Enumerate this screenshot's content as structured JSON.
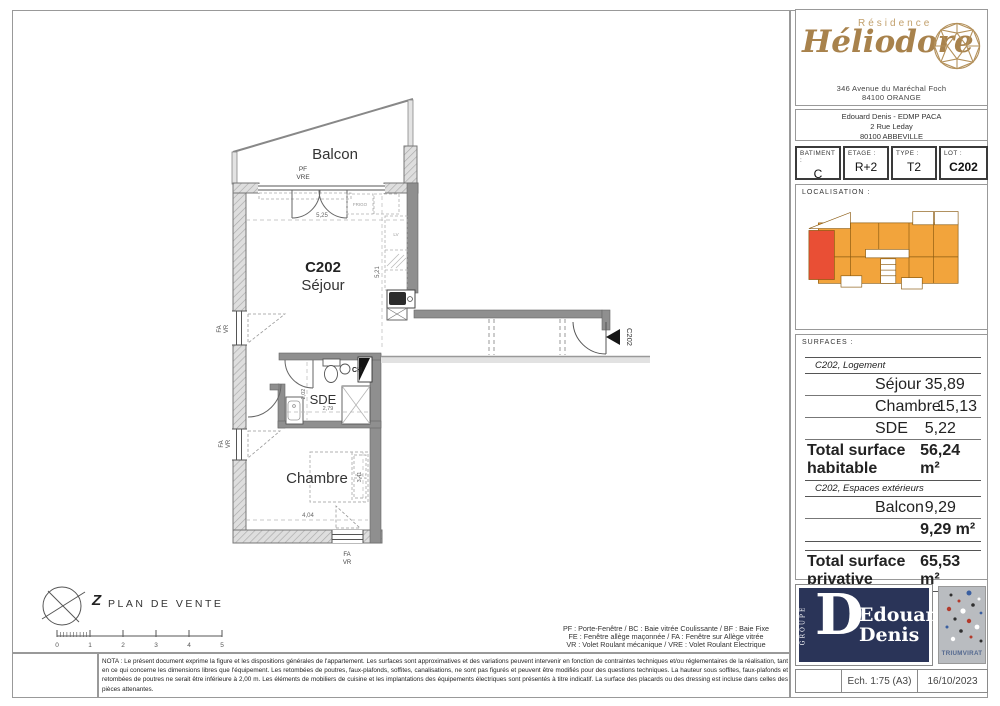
{
  "sheet": {
    "residence_label": "Résidence",
    "residence_name": "Héliodore",
    "residence_address1": "346 Avenue du Maréchal Foch",
    "residence_address2": "84100 ORANGE",
    "promoter_line1": "Edouard Denis - EDMP PACA",
    "promoter_line2": "2 Rue Leday",
    "promoter_line3": "80100 ABBEVILLE"
  },
  "lot": {
    "cells": [
      {
        "label": "BATIMENT :",
        "value": "C"
      },
      {
        "label": "ETAGE :",
        "value": "R+2"
      },
      {
        "label": "TYPE :",
        "value": "T2"
      },
      {
        "label": "LOT :",
        "value": "C202"
      }
    ]
  },
  "localisation": {
    "label": "LOCALISATION :"
  },
  "surfaces": {
    "label": "SURFACES :",
    "group1_title": "C202, Logement",
    "rows1": [
      {
        "name": "Séjour",
        "value": "35,89"
      },
      {
        "name": "Chambre",
        "value": "15,13"
      },
      {
        "name": "SDE",
        "value": "5,22"
      }
    ],
    "total1_label": "Total surface habitable",
    "total1_value": "56,24 m²",
    "group2_title": "C202, Espaces extérieurs",
    "rows2": [
      {
        "name": "Balcon",
        "value": "9,29"
      }
    ],
    "subtotal2_value": "9,29 m²",
    "grand_total_label": "Total surface privative",
    "grand_total_value": "65,53 m²"
  },
  "plan": {
    "balcon": "Balcon",
    "pf": "PF",
    "vre": "VRE",
    "unit": "C202",
    "sejour": "Séjour",
    "sde": "SDE",
    "chambre": "Chambre",
    "frigo": "FRIGO",
    "lv": "LV",
    "ch": "CH",
    "fa": "FA",
    "vr": "VR",
    "entry_label": "C202",
    "dims": {
      "sejour_w": "5,25",
      "sejour_h": "5,21",
      "sde_h": "2,02",
      "sde_w": "2,79",
      "chambre_w": "4,04",
      "chambre_h": "3,41"
    }
  },
  "plan_footer": {
    "title": "PLAN DE VENTE",
    "north": "Z",
    "scale_ticks": [
      "0",
      "1",
      "2",
      "3",
      "4",
      "5"
    ]
  },
  "legend": {
    "line1": "PF : Porte-Fenêtre / BC : Baie vitrée Coulissante / BF : Baie Fixe",
    "line2": "FE : Fenêtre allège maçonnée / FA : Fenêtre sur Allège vitrée",
    "line3": "VR : Volet Roulant mécanique / VRE : Volet Roulant Electrique"
  },
  "nota": "NOTA : Le présent document exprime la figure et les dispositions générales de l'appartement. Les surfaces sont approximatives et des variations peuvent intervenir en fonction de contraintes techniques et/ou réglementaires de la réalisation, tant en ce qui concerne les dimensions libres que l'équipement. Les retombées de poutres, faux-plafonds, soffites, canalisations, ne sont pas figurés et peuvent être modifiés pour des questions techniques. La hauteur sous soffites, faux-plafonds et retombées de poutres ne serait être inférieure à 2,00 m. Les éléments de mobiliers de cuisine et les implantations des équipements électriques sont présentés à titre indicatif. La surface des placards ou des dressing est incluse dans celles des pièces attenantes.",
  "branding": {
    "groupe": "GROUPE",
    "initial": "D",
    "name1": "Edouard",
    "name2": "Denis",
    "certifier": "TRIUMVIRAT"
  },
  "titleblock": {
    "scale": "Ech. 1:75 (A3)",
    "date": "16/10/2023"
  },
  "colors": {
    "gold": "#b3905a",
    "navy": "#2a3458",
    "map_orange": "#F2A43C",
    "map_red": "#E94F35"
  }
}
